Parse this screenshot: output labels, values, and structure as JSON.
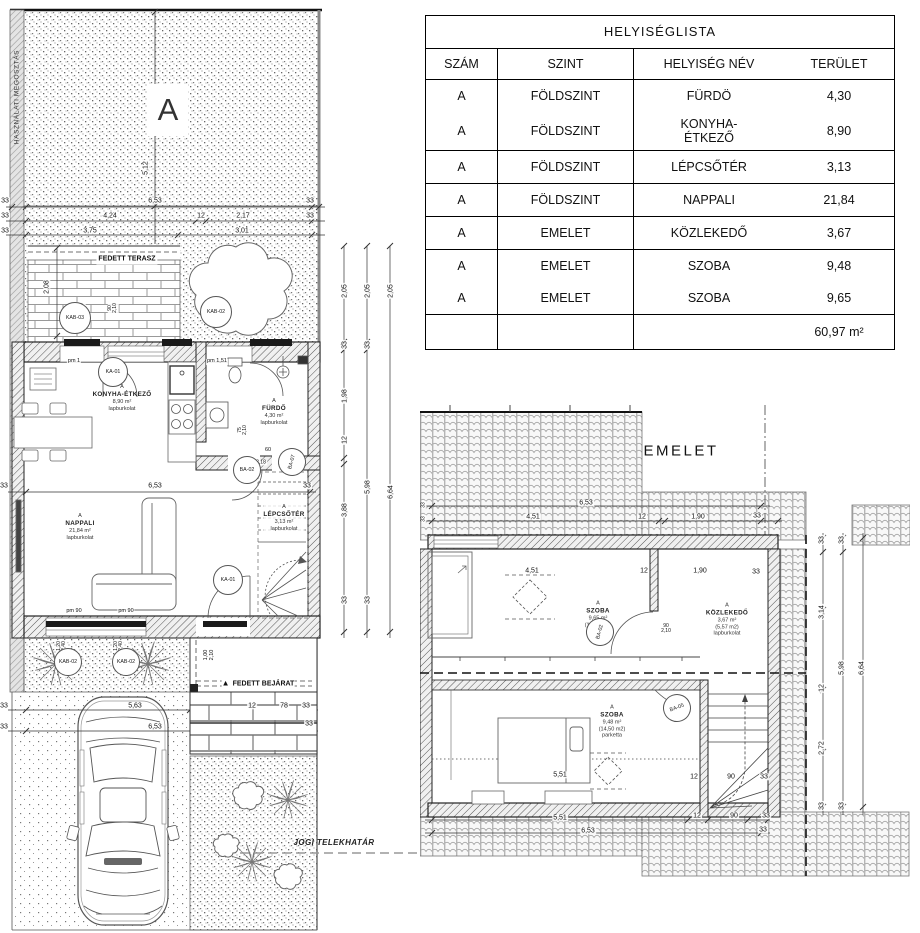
{
  "room_list_table": {
    "title": "HELYISÉGLISTA",
    "columns": [
      "SZÁM",
      "SZINT",
      "HELYISÉG NÉV",
      "TERÜLET"
    ],
    "rows": [
      [
        "A",
        "FÖLDSZINT",
        "FÜRDÖ",
        "4,30"
      ],
      [
        "A",
        "FÖLDSZINT",
        "KONYHA-\nÉTKEZŐ",
        "8,90"
      ],
      [
        "A",
        "FÖLDSZINT",
        "LÉPCSŐTÉR",
        "3,13"
      ],
      [
        "A",
        "FÖLDSZINT",
        "NAPPALI",
        "21,84"
      ],
      [
        "A",
        "EMELET",
        "KÖZLEKEDŐ",
        "3,67"
      ],
      [
        "A",
        "EMELET",
        "SZOBA",
        "9,48"
      ],
      [
        "A",
        "EMELET",
        "SZOBA",
        "9,65"
      ]
    ],
    "total": "60,97 m²"
  },
  "ground_floor_plan": {
    "division_text": "HASZNÁLATI MEGOSZTÁS",
    "unit_marker": "A",
    "terrace_label": "FEDETT TERASZ",
    "entrance_label": "FEDETT BEJÁRAT",
    "entrance_marker": "▲",
    "boundary_label": "JOGI TELEKHATÁR",
    "rooms": {
      "kitchen": {
        "unit": "A",
        "name": "KONYHA-ÉTKEZŐ",
        "area": "8,90 m²",
        "finish": "lapburkolat"
      },
      "bathroom": {
        "unit": "A",
        "name": "FÜRDŐ",
        "area": "4,30 m²",
        "finish": "lapburkolat"
      },
      "living": {
        "unit": "A",
        "name": "NAPPALI",
        "area": "21,84 m²",
        "finish": "lapburkolat"
      },
      "stairwell": {
        "unit": "A",
        "name": "LÉPCSŐTÉR",
        "area": "3,13 m²",
        "finish": "lapburkolat"
      }
    }
  },
  "upper_floor_plan": {
    "title": "EMELET",
    "rooms": {
      "room_front": {
        "unit": "A",
        "name": "SZOBA",
        "area": "9,65 m²",
        "gross": "(14,16 m2)",
        "finish": "parketta"
      },
      "hall": {
        "unit": "A",
        "name": "KÖZLEKEDŐ",
        "area": "3,67 m²",
        "gross": "(5,57 m2)",
        "finish": "lapburkolat"
      },
      "room_back": {
        "unit": "A",
        "name": "SZOBA",
        "area": "9,48 m²",
        "gross": "(14,50 m2)",
        "finish": "parketta"
      }
    }
  },
  "door_tags": [
    {
      "t": "KAB-03",
      "x": 75,
      "y": 318,
      "d": 30
    },
    {
      "t": "KAB-02",
      "x": 216,
      "y": 312,
      "d": 30
    },
    {
      "t": "KA-01",
      "x": 113,
      "y": 372,
      "d": 28
    },
    {
      "t": "BA-02",
      "x": 247,
      "y": 470,
      "d": 26
    },
    {
      "t": "BA-07",
      "x": 292,
      "y": 462,
      "d": 26,
      "r": -75
    },
    {
      "t": "KA-01",
      "x": 228,
      "y": 580,
      "d": 28
    },
    {
      "t": "KAB-02",
      "x": 68,
      "y": 662,
      "d": 26
    },
    {
      "t": "KAB-02",
      "x": 126,
      "y": 662,
      "d": 26
    },
    {
      "t": "BA-02",
      "x": 600,
      "y": 632,
      "d": 26,
      "r": -75
    },
    {
      "t": "BA-05",
      "x": 677,
      "y": 708,
      "d": 26,
      "r": -20
    }
  ],
  "dimension_labels": [
    {
      "t": "5,12",
      "x": 146,
      "y": 168,
      "r": 1
    },
    {
      "t": "33",
      "x": 5,
      "y": 201
    },
    {
      "t": "6,53",
      "x": 155,
      "y": 201
    },
    {
      "t": "33",
      "x": 310,
      "y": 201
    },
    {
      "t": "33",
      "x": 5,
      "y": 216
    },
    {
      "t": "4,24",
      "x": 110,
      "y": 216
    },
    {
      "t": "12",
      "x": 201,
      "y": 216
    },
    {
      "t": "2,17",
      "x": 243,
      "y": 216
    },
    {
      "t": "33",
      "x": 310,
      "y": 216
    },
    {
      "t": "33",
      "x": 5,
      "y": 231
    },
    {
      "t": "3,75",
      "x": 90,
      "y": 231
    },
    {
      "t": "3,01",
      "x": 242,
      "y": 231
    },
    {
      "t": "2,08",
      "x": 47,
      "y": 287,
      "r": 1
    },
    {
      "t": "40\n2,10",
      "x": 80,
      "y": 308,
      "r": 1,
      "s": 5
    },
    {
      "t": "90\n2,10",
      "x": 113,
      "y": 308,
      "r": 1,
      "s": 5
    },
    {
      "t": "90\n2,10",
      "x": 220,
      "y": 308,
      "r": 1,
      "s": 5
    },
    {
      "t": "pm 1",
      "x": 74,
      "y": 362,
      "s": 5.5
    },
    {
      "t": "pm 1,51",
      "x": 217,
      "y": 362,
      "s": 5.5
    },
    {
      "t": "75\n2,10",
      "x": 243,
      "y": 430,
      "r": 1,
      "s": 5
    },
    {
      "t": "60",
      "x": 268,
      "y": 451,
      "s": 5.5
    },
    {
      "t": "3,18",
      "x": 261,
      "y": 463,
      "s": 5
    },
    {
      "t": "33",
      "x": 4,
      "y": 486
    },
    {
      "t": "6,53",
      "x": 155,
      "y": 486
    },
    {
      "t": "33",
      "x": 307,
      "y": 486
    },
    {
      "t": "pm 90",
      "x": 74,
      "y": 612,
      "s": 5.5
    },
    {
      "t": "pm 90",
      "x": 126,
      "y": 612,
      "s": 5.5
    },
    {
      "t": "1,20\n2,40",
      "x": 62,
      "y": 646,
      "r": 1,
      "s": 5
    },
    {
      "t": "1,20\n2,40",
      "x": 119,
      "y": 646,
      "r": 1,
      "s": 5
    },
    {
      "t": "1,00\n2,10",
      "x": 210,
      "y": 655,
      "r": 1,
      "s": 5.5
    },
    {
      "t": "33",
      "x": 4,
      "y": 706
    },
    {
      "t": "5,63",
      "x": 135,
      "y": 706
    },
    {
      "t": "12",
      "x": 252,
      "y": 706
    },
    {
      "t": "78",
      "x": 284,
      "y": 706
    },
    {
      "t": "33",
      "x": 306,
      "y": 706
    },
    {
      "t": "33",
      "x": 4,
      "y": 727
    },
    {
      "t": "6,53",
      "x": 155,
      "y": 727
    },
    {
      "t": "33",
      "x": 309,
      "y": 724
    },
    {
      "t": "2,05",
      "x": 345,
      "y": 291,
      "r": 1
    },
    {
      "t": "33",
      "x": 345,
      "y": 345,
      "r": 1
    },
    {
      "t": "1,98",
      "x": 345,
      "y": 396,
      "r": 1
    },
    {
      "t": "12",
      "x": 345,
      "y": 440,
      "r": 1
    },
    {
      "t": "3,88",
      "x": 345,
      "y": 510,
      "r": 1
    },
    {
      "t": "33",
      "x": 345,
      "y": 600,
      "r": 1
    },
    {
      "t": "2,05",
      "x": 368,
      "y": 291,
      "r": 1
    },
    {
      "t": "33",
      "x": 368,
      "y": 345,
      "r": 1
    },
    {
      "t": "5,98",
      "x": 368,
      "y": 487,
      "r": 1
    },
    {
      "t": "33",
      "x": 368,
      "y": 600,
      "r": 1
    },
    {
      "t": "2,05",
      "x": 391,
      "y": 291,
      "r": 1
    },
    {
      "t": "6,64",
      "x": 391,
      "y": 492,
      "r": 1
    },
    {
      "t": "33",
      "x": 424,
      "y": 505,
      "r": 1,
      "s": 5
    },
    {
      "t": "33",
      "x": 424,
      "y": 519,
      "r": 1,
      "s": 5
    },
    {
      "t": "6,53",
      "x": 586,
      "y": 503
    },
    {
      "t": "4,51",
      "x": 533,
      "y": 517
    },
    {
      "t": "12",
      "x": 642,
      "y": 517
    },
    {
      "t": "1,90",
      "x": 698,
      "y": 517
    },
    {
      "t": "33",
      "x": 757,
      "y": 516
    },
    {
      "t": "4,51",
      "x": 532,
      "y": 571
    },
    {
      "t": "12",
      "x": 644,
      "y": 571
    },
    {
      "t": "1,90",
      "x": 700,
      "y": 571
    },
    {
      "t": "33",
      "x": 756,
      "y": 572
    },
    {
      "t": "90\n2,10",
      "x": 666,
      "y": 629,
      "s": 5
    },
    {
      "t": "5,51",
      "x": 560,
      "y": 775
    },
    {
      "t": "12",
      "x": 694,
      "y": 777
    },
    {
      "t": "90",
      "x": 731,
      "y": 777
    },
    {
      "t": "33",
      "x": 764,
      "y": 777
    },
    {
      "t": "5,51",
      "x": 560,
      "y": 818
    },
    {
      "t": "6,53",
      "x": 588,
      "y": 831
    },
    {
      "t": "12",
      "x": 697,
      "y": 816
    },
    {
      "t": "90",
      "x": 734,
      "y": 816
    },
    {
      "t": "33",
      "x": 766,
      "y": 816
    },
    {
      "t": "33",
      "x": 763,
      "y": 830
    },
    {
      "t": "33",
      "x": 822,
      "y": 540,
      "r": 1
    },
    {
      "t": "3,14",
      "x": 822,
      "y": 612,
      "r": 1
    },
    {
      "t": "12",
      "x": 822,
      "y": 688,
      "r": 1
    },
    {
      "t": "2,72",
      "x": 822,
      "y": 748,
      "r": 1
    },
    {
      "t": "33",
      "x": 822,
      "y": 806,
      "r": 1
    },
    {
      "t": "33",
      "x": 842,
      "y": 540,
      "r": 1
    },
    {
      "t": "5,98",
      "x": 842,
      "y": 668,
      "r": 1
    },
    {
      "t": "33",
      "x": 842,
      "y": 806,
      "r": 1
    },
    {
      "t": "6,64",
      "x": 862,
      "y": 668,
      "r": 1
    }
  ]
}
